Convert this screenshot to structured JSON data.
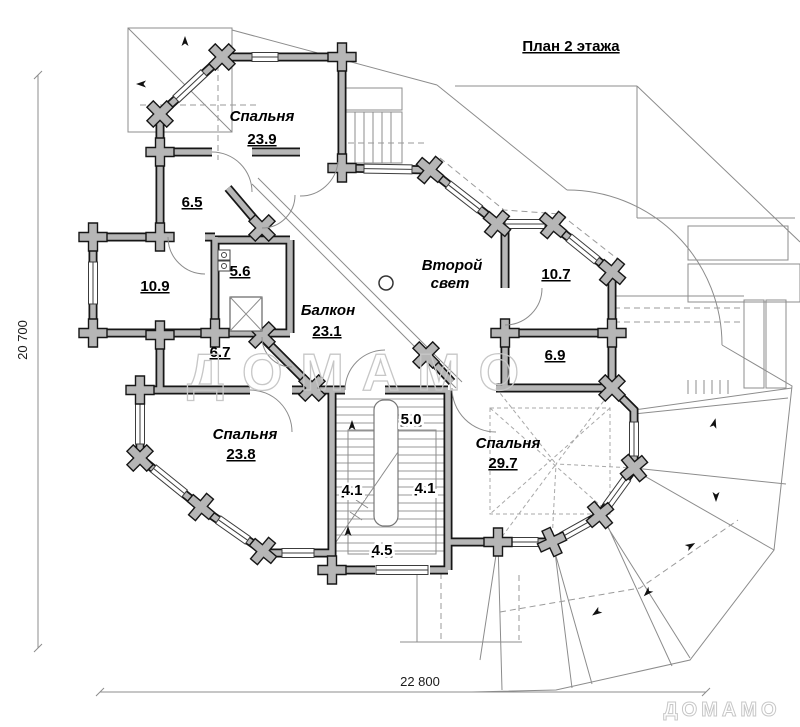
{
  "title": "План 2 этажа",
  "rooms": [
    {
      "name": "Спальня",
      "area": "23.9"
    },
    {
      "area": "6.5"
    },
    {
      "area": "10.9"
    },
    {
      "area": "5.6"
    },
    {
      "name": "Балкон",
      "area": "23.1"
    },
    {
      "name_lines": [
        "Второй",
        "свет"
      ]
    },
    {
      "area": "10.7"
    },
    {
      "area": "6.7"
    },
    {
      "area": "6.9"
    },
    {
      "name": "Спальня",
      "area": "23.8"
    },
    {
      "area": "5.0"
    },
    {
      "area": "4.1"
    },
    {
      "area": "4.1"
    },
    {
      "area": "4.5"
    },
    {
      "name": "Спальня",
      "area": "29.7"
    }
  ],
  "dimensions": {
    "height_mm": "20 700",
    "width_mm": "22 800"
  },
  "watermarks": {
    "center": "ДОМАМО",
    "corner": "ДОМАМО"
  },
  "colors": {
    "wall_fill": "#b6b6b6",
    "wall_outline": "#161616",
    "thin_line": "#8c8c8c",
    "watermark": "#c7c7c7",
    "text": "#000000",
    "background": "#ffffff"
  }
}
